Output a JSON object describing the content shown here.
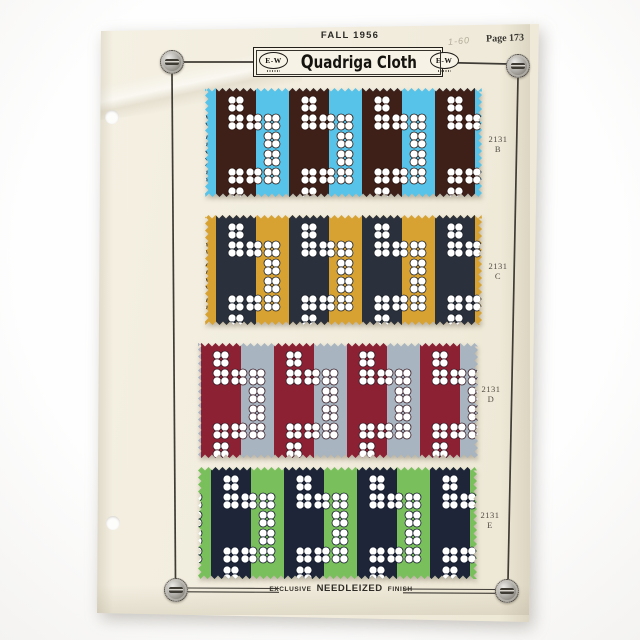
{
  "page": {
    "season": "FALL 1956",
    "page_number": "Page 173",
    "handwritten_note": "1-60",
    "brand": {
      "title": "Quadriga Cloth",
      "logo_text": "E-W"
    },
    "footer": {
      "exclusive": "EXCLUSIVE",
      "finish_name": "NEEDLEIZED",
      "finish": "FINISH"
    }
  },
  "swatches": [
    {
      "style_number": "2131",
      "colorway_letter": "B",
      "light_color": "#57c3e8",
      "dark_color": "#3f2019",
      "outline_color": "#2a1510",
      "petal_color": "#ffffff"
    },
    {
      "style_number": "2131",
      "colorway_letter": "C",
      "light_color": "#d8a233",
      "dark_color": "#2b313c",
      "outline_color": "#1b2028",
      "petal_color": "#ffffff"
    },
    {
      "style_number": "2131",
      "colorway_letter": "D",
      "light_color": "#a8b4bf",
      "dark_color": "#8d2134",
      "outline_color": "#351a24",
      "petal_color": "#ffffff"
    },
    {
      "style_number": "2131",
      "colorway_letter": "E",
      "light_color": "#79c05c",
      "dark_color": "#1e2538",
      "outline_color": "#131a2b",
      "petal_color": "#ffffff"
    }
  ],
  "colors": {
    "paper": "#f2eddf",
    "frame": "#3f3b35",
    "background": "#fbfbfa"
  }
}
